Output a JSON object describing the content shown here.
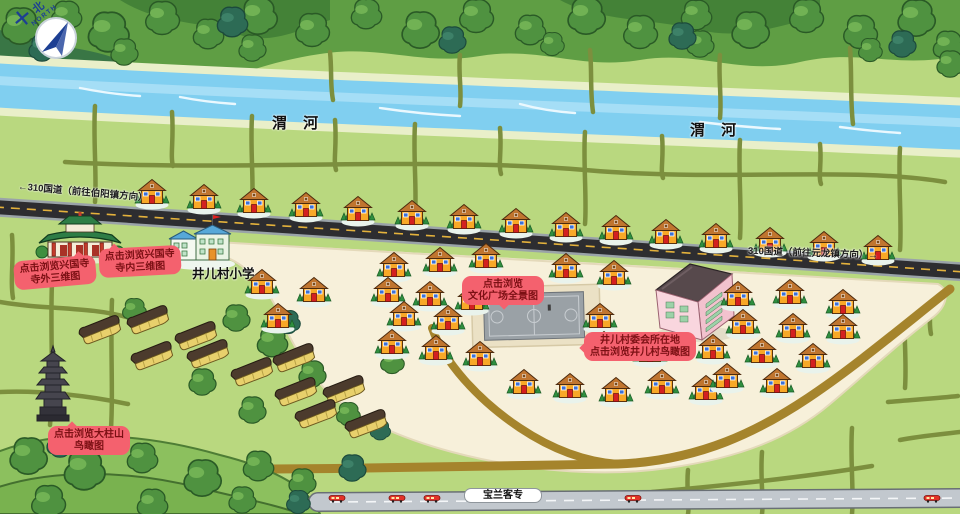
{
  "compass": {
    "cn": "北",
    "en": "NORTH"
  },
  "river": {
    "labels": [
      {
        "text": "渭 河",
        "x": 272,
        "y": 112
      },
      {
        "text": "渭 河",
        "x": 690,
        "y": 119
      }
    ]
  },
  "highway": {
    "label_left": {
      "text": "←310国道（前往伯阳镇方向）",
      "x": 18,
      "y": 184,
      "rot": 5
    },
    "label_right": {
      "text": "310国道（前往元龙镇方向）→",
      "x": 748,
      "y": 245,
      "rot": 2
    }
  },
  "school": {
    "label": "井儿村小学"
  },
  "railway": {
    "label": "宝兰客专",
    "trains": [
      337,
      397,
      432,
      633,
      932
    ]
  },
  "callouts": [
    {
      "id": "temple-exterior",
      "lines": [
        "点击浏览兴国寺",
        "寺外三维图"
      ],
      "x": 14,
      "y": 258,
      "rot": -5,
      "tail": "top-right"
    },
    {
      "id": "temple-interior",
      "lines": [
        "点击浏览兴国寺",
        "寺内三维图"
      ],
      "x": 99,
      "y": 247,
      "rot": -3,
      "tail": "top-left"
    },
    {
      "id": "culture-square",
      "lines": [
        "点击浏览",
        "文化广场全景图"
      ],
      "x": 462,
      "y": 276,
      "rot": 0,
      "tail": "bottom"
    },
    {
      "id": "village-committee",
      "lines": [
        "井儿村委会所在地",
        "点击浏览井儿村鸟瞰图"
      ],
      "x": 584,
      "y": 332,
      "rot": 0,
      "tail": "left"
    },
    {
      "id": "dazhushan",
      "lines": [
        "点击浏览大柱山",
        "鸟瞰图"
      ],
      "x": 48,
      "y": 426,
      "rot": 0,
      "tail": "top"
    }
  ],
  "colors": {
    "field_green": "#b9d87f",
    "river_blue": "#80cff0",
    "road_dark": "#2d2d30",
    "road_dash_yellow": "#e4b23c",
    "village_ground": "#f7f0da",
    "brown_road": "#a5842c",
    "railway_gray": "#c2c8ce",
    "callout_bg": "#f4616e",
    "callout_text": "#7c1014",
    "house_wall": "#f8a827",
    "house_roof": "#c0752f",
    "train_red": "#e23228"
  },
  "map": {
    "houses": [
      [
        152,
        193
      ],
      [
        204,
        198
      ],
      [
        254,
        202
      ],
      [
        306,
        206
      ],
      [
        358,
        210
      ],
      [
        412,
        214
      ],
      [
        464,
        218
      ],
      [
        516,
        222
      ],
      [
        566,
        226
      ],
      [
        616,
        229
      ],
      [
        666,
        233
      ],
      [
        716,
        237
      ],
      [
        770,
        241
      ],
      [
        824,
        245
      ],
      [
        878,
        249
      ],
      [
        262,
        283
      ],
      [
        314,
        291
      ],
      [
        278,
        317
      ],
      [
        394,
        266
      ],
      [
        440,
        261
      ],
      [
        486,
        257
      ],
      [
        566,
        267
      ],
      [
        614,
        274
      ],
      [
        388,
        291
      ],
      [
        430,
        295
      ],
      [
        472,
        299
      ],
      [
        404,
        315
      ],
      [
        448,
        319
      ],
      [
        392,
        343
      ],
      [
        436,
        349
      ],
      [
        480,
        355
      ],
      [
        524,
        383
      ],
      [
        570,
        387
      ],
      [
        616,
        391
      ],
      [
        600,
        317
      ],
      [
        604,
        345
      ],
      [
        650,
        351
      ],
      [
        662,
        383
      ],
      [
        706,
        389
      ],
      [
        738,
        295
      ],
      [
        790,
        293
      ],
      [
        843,
        303
      ],
      [
        743,
        323
      ],
      [
        793,
        327
      ],
      [
        843,
        328
      ],
      [
        713,
        348
      ],
      [
        762,
        352
      ],
      [
        813,
        357
      ],
      [
        727,
        377
      ],
      [
        777,
        382
      ]
    ],
    "greenhouses": [
      [
        100,
        330
      ],
      [
        148,
        320
      ],
      [
        196,
        336
      ],
      [
        152,
        356
      ],
      [
        208,
        354
      ],
      [
        252,
        372
      ],
      [
        294,
        358
      ],
      [
        296,
        392
      ],
      [
        344,
        390
      ],
      [
        316,
        414
      ],
      [
        366,
        424
      ]
    ],
    "trees": [
      [
        20,
        26,
        1.1,
        0
      ],
      [
        66,
        16,
        0.9,
        0
      ],
      [
        108,
        32,
        1.2,
        0
      ],
      [
        162,
        18,
        1,
        0
      ],
      [
        208,
        34,
        0.9,
        0
      ],
      [
        258,
        16,
        1.1,
        0
      ],
      [
        312,
        30,
        1,
        0
      ],
      [
        366,
        14,
        0.9,
        0
      ],
      [
        420,
        30,
        1.1,
        0
      ],
      [
        476,
        16,
        1,
        0
      ],
      [
        530,
        30,
        0.9,
        0
      ],
      [
        586,
        16,
        1.1,
        0
      ],
      [
        640,
        32,
        1,
        0
      ],
      [
        696,
        15,
        0.9,
        0
      ],
      [
        750,
        30,
        1.1,
        0
      ],
      [
        806,
        16,
        1,
        0
      ],
      [
        860,
        32,
        1,
        0
      ],
      [
        916,
        18,
        1.1,
        0
      ],
      [
        948,
        46,
        0.9,
        0
      ],
      [
        124,
        52,
        0.8,
        0
      ],
      [
        252,
        48,
        0.8,
        0
      ],
      [
        552,
        44,
        0.7,
        0
      ],
      [
        700,
        44,
        0.8,
        0
      ],
      [
        870,
        50,
        0.7,
        0
      ],
      [
        42,
        48,
        0.8,
        1
      ],
      [
        232,
        22,
        0.9,
        1
      ],
      [
        452,
        40,
        0.8,
        1
      ],
      [
        682,
        36,
        0.8,
        1
      ],
      [
        902,
        44,
        0.8,
        1
      ],
      [
        28,
        456,
        1.1,
        0
      ],
      [
        84,
        470,
        1.2,
        0
      ],
      [
        142,
        458,
        0.9,
        0
      ],
      [
        202,
        478,
        1.1,
        0
      ],
      [
        258,
        466,
        0.9,
        0
      ],
      [
        48,
        502,
        1,
        0
      ],
      [
        152,
        504,
        0.9,
        0
      ],
      [
        242,
        500,
        0.8,
        0
      ],
      [
        302,
        482,
        0.8,
        0
      ],
      [
        352,
        468,
        0.8,
        1
      ],
      [
        60,
        444,
        0.8,
        1
      ],
      [
        298,
        502,
        0.7,
        1
      ],
      [
        236,
        318,
        0.8,
        0
      ],
      [
        272,
        342,
        0.9,
        0
      ],
      [
        202,
        382,
        0.8,
        0
      ],
      [
        252,
        410,
        0.8,
        0
      ],
      [
        312,
        374,
        0.8,
        0
      ],
      [
        348,
        414,
        0.7,
        0
      ],
      [
        134,
        310,
        0.7,
        0
      ],
      [
        392,
        362,
        0.7,
        0
      ],
      [
        288,
        322,
        0.7,
        1
      ],
      [
        380,
        430,
        0.6,
        1
      ],
      [
        950,
        64,
        0.8,
        0
      ]
    ]
  }
}
